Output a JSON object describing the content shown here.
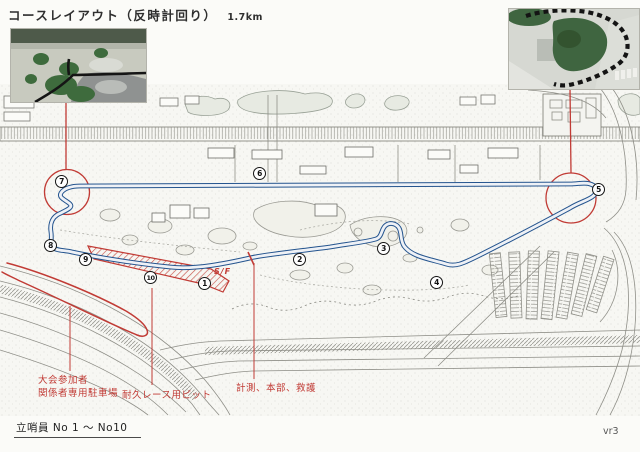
{
  "title": {
    "text": "コースレイアウト（反時計回り）",
    "distance": "1.7km"
  },
  "annotations": {
    "parking_line1": "大会参加者",
    "parking_line2": "関係者専用駐車場",
    "pit": "耐久レース用ピット",
    "hq": "計測、本部、救護",
    "start_finish": "S/F"
  },
  "markers": {
    "labels": [
      "1",
      "2",
      "3",
      "4",
      "5",
      "6",
      "7",
      "8",
      "9",
      "10"
    ]
  },
  "footer": {
    "staff_note": "立哨員 No 1 ～ No10",
    "version": "vr3"
  },
  "colors": {
    "course_blue": "#24548e",
    "annotation_red": "#c13b35",
    "ink_gray": "#8a8a8a"
  }
}
